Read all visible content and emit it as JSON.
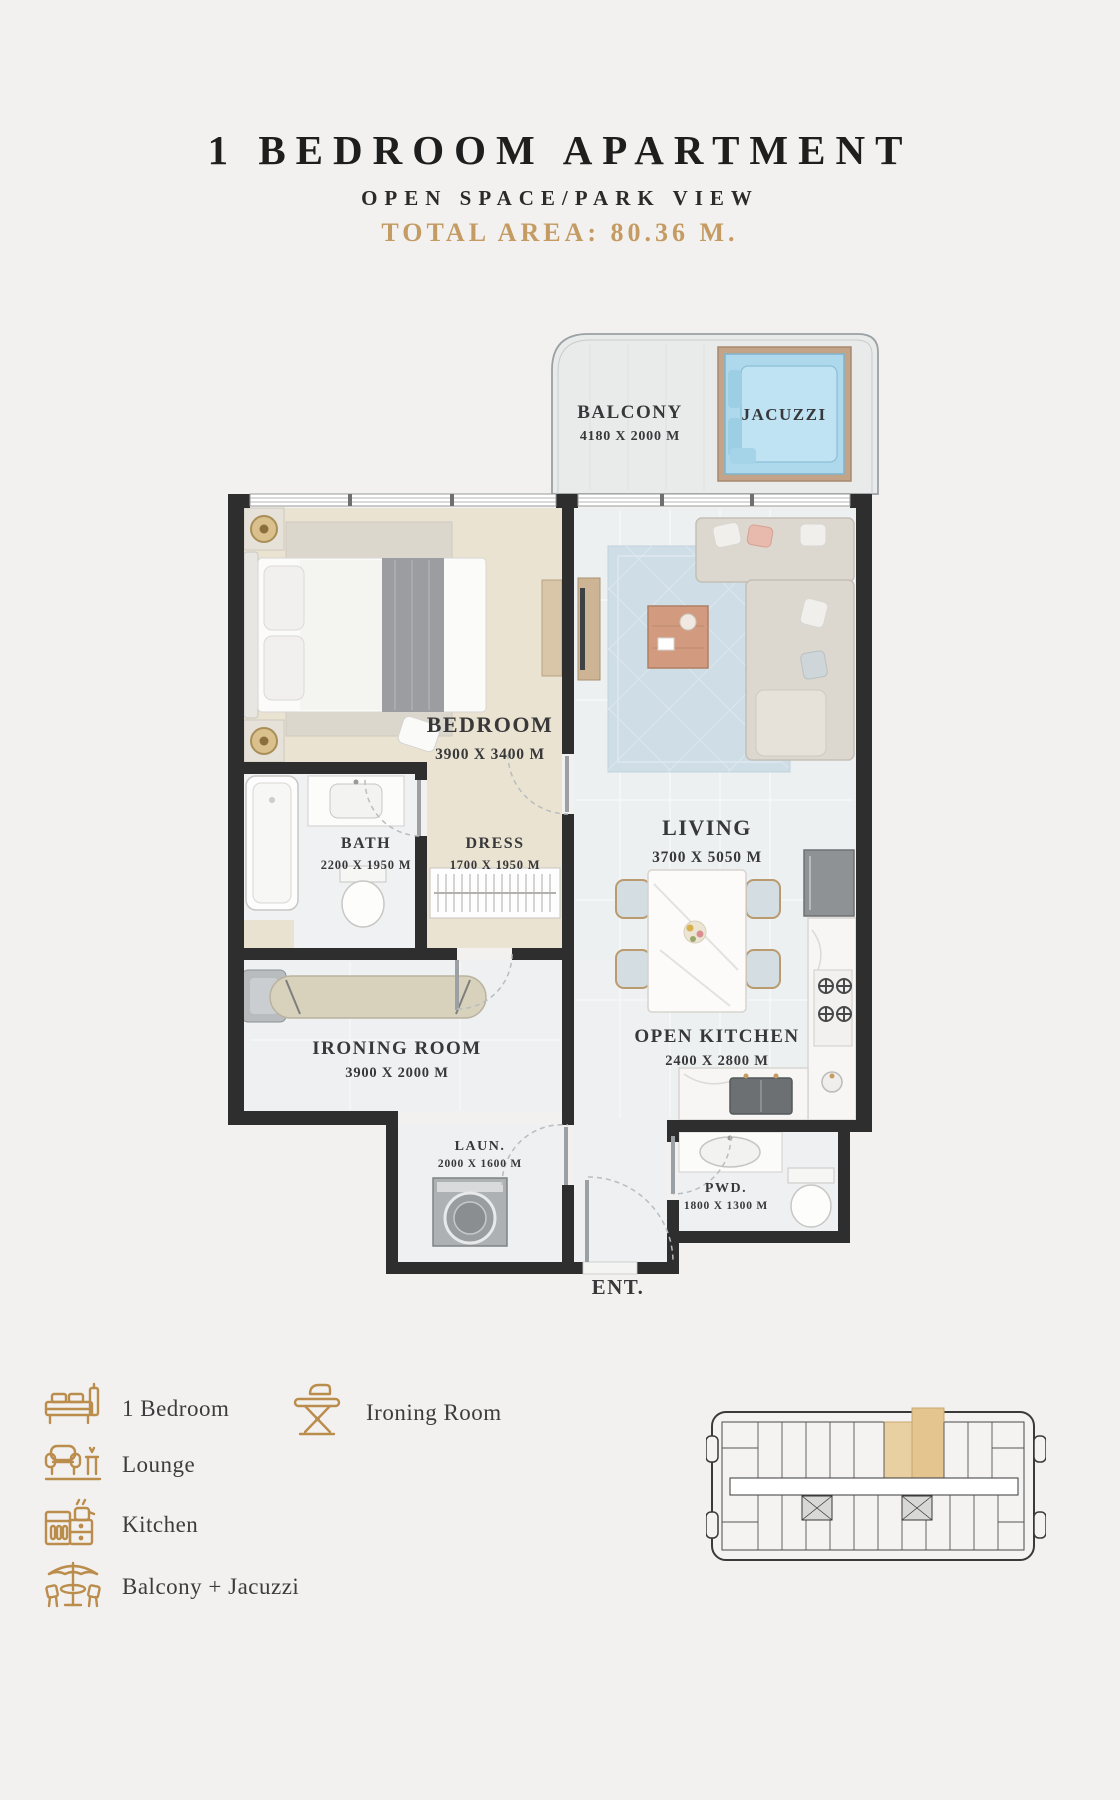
{
  "header": {
    "title": "1 BEDROOM APARTMENT",
    "subtitle": "OPEN SPACE/PARK VIEW",
    "total_area": "TOTAL AREA: 80.36 M."
  },
  "floorplan": {
    "rooms": [
      {
        "name": "BALCONY",
        "dims": "4180 X 2000 M"
      },
      {
        "name": "JACUZZI",
        "dims": ""
      },
      {
        "name": "BEDROOM",
        "dims": "3900 X 3400 M"
      },
      {
        "name": "DRESS",
        "dims": "1700 X 1950 M"
      },
      {
        "name": "BATH",
        "dims": "2200 X 1950 M"
      },
      {
        "name": "LIVING",
        "dims": "3700 X 5050 M"
      },
      {
        "name": "OPEN KITCHEN",
        "dims": "2400 X 2800 M"
      },
      {
        "name": "IRONING ROOM",
        "dims": "3900 X 2000 M"
      },
      {
        "name": "LAUN.",
        "dims": "2000 X 1600 M"
      },
      {
        "name": "PWD.",
        "dims": "1800 X 1300 M"
      }
    ],
    "entrance": "ENT."
  },
  "legend": {
    "items": [
      {
        "icon": "bed-icon",
        "label": "1 Bedroom"
      },
      {
        "icon": "lounge-icon",
        "label": "Lounge"
      },
      {
        "icon": "kitchen-icon",
        "label": "Kitchen"
      },
      {
        "icon": "balcony-jacuzzi-icon",
        "label": "Balcony + Jacuzzi"
      },
      {
        "icon": "ironing-room-icon",
        "label": "Ironing Room"
      }
    ]
  },
  "colors": {
    "accent_gold": "#c49c63",
    "wall": "#2e2e2e",
    "bedroom_floor": "#eae3d2",
    "tile_floor": "#eef0f1",
    "jacuzzi_water": "#aed9ec",
    "rug_blue": "#cfdde7"
  }
}
